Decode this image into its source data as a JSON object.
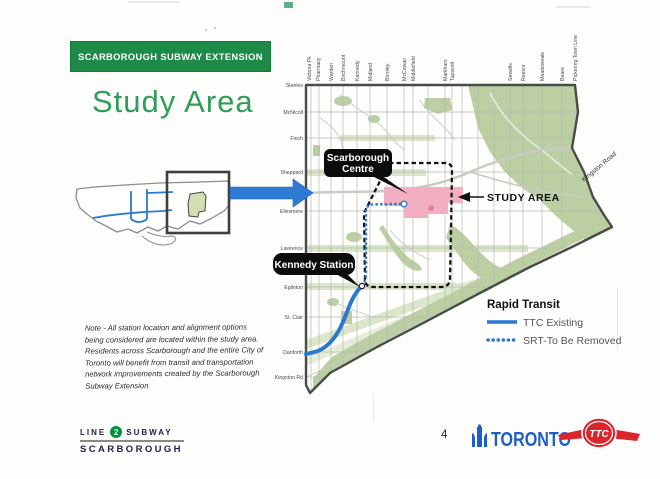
{
  "slide": {
    "banner": "SCARBOROUGH SUBWAY EXTENSION",
    "title": "Study Area",
    "note": "Note - All station location and alignment options being considered are located within the study area. Residents across Scarborough and the entire City of Toronto will benefit from transit and transportation network improvements created by the Scarborough Subway Extension",
    "page_number": "4"
  },
  "map": {
    "streets_top": [
      "Victoria Pk",
      "Pharmacy",
      "Warden",
      "Birchmount",
      "Kennedy",
      "Midland",
      "Brimley",
      "McCowan",
      "Middlefield",
      "Markham",
      "Tapscott",
      "Sewells",
      "Reesor",
      "Meadowvale",
      "Beare",
      "Pickering Town Line"
    ],
    "streets_left": [
      "Steeles",
      "McNicoll",
      "Finch",
      "Sheppard",
      "Ellesmere",
      "Lawrence",
      "Eglinton",
      "St. Clair",
      "Danforth",
      "Kingston Rd"
    ],
    "kingston_road_label": "Kingston Road",
    "callouts": {
      "scarborough_centre": [
        "Scarborough",
        "Centre"
      ],
      "kennedy_station": "Kennedy Station",
      "study_area": "STUDY AREA"
    }
  },
  "legend": {
    "title": "Rapid Transit",
    "items": [
      {
        "label": "TTC Existing",
        "style": "solid"
      },
      {
        "label": "SRT-To Be Removed",
        "style": "dotted"
      }
    ]
  },
  "footer": {
    "line_badge": {
      "prefix": "LINE",
      "number": "2",
      "suffix": "SUBWAY",
      "name": "SCARBOROUGH"
    },
    "toronto_wordmark": "TORONTO",
    "ttc_logo": "TTC"
  },
  "colors": {
    "header_green": "#1d8a47",
    "title_green": "#2f9e5b",
    "ttc_blue": "#2b79cf",
    "arrow_blue": "#2e7bd6",
    "study_area_pink": "#f3aec1",
    "park_green": "#bccfa3",
    "corridor_green": "#dbe6ca",
    "line2_green": "#00923f",
    "toronto_blue": "#1d5ec7",
    "ttc_red": "#d9252b"
  }
}
